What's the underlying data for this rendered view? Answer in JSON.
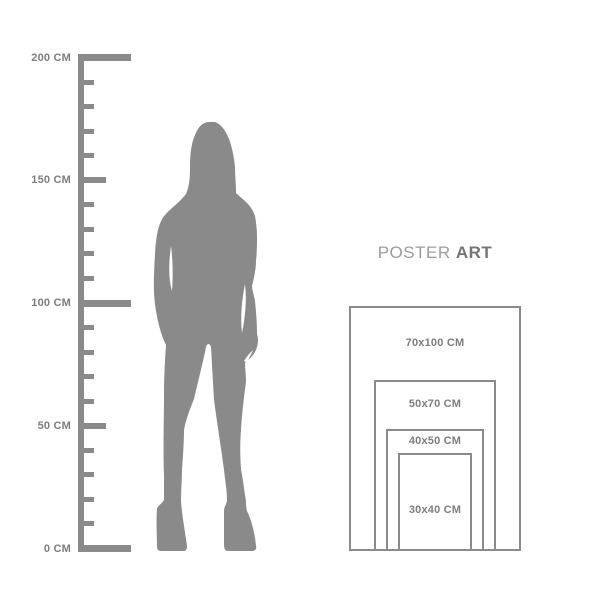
{
  "title": {
    "normal": "POSTER",
    "bold": "ART"
  },
  "ruler": {
    "unit": "CM",
    "max_cm": 200,
    "minor_step_cm": 10,
    "labels": [
      {
        "cm": 200,
        "text": "200 CM"
      },
      {
        "cm": 150,
        "text": "150 CM"
      },
      {
        "cm": 100,
        "text": "100 CM"
      },
      {
        "cm": 50,
        "text": "50 CM"
      },
      {
        "cm": 0,
        "text": "0 CM"
      }
    ]
  },
  "figure": {
    "name": "woman-silhouette",
    "color": "#8a8a8a"
  },
  "posters": {
    "sizes": [
      {
        "id": "70x100",
        "label": "70x100 CM",
        "width_cm": 70,
        "height_cm": 100
      },
      {
        "id": "50x70",
        "label": "50x70 CM",
        "width_cm": 50,
        "height_cm": 70
      },
      {
        "id": "40x50",
        "label": "40x50 CM",
        "width_cm": 40,
        "height_cm": 50
      },
      {
        "id": "30x40",
        "label": "30x40 CM",
        "width_cm": 30,
        "height_cm": 40
      }
    ]
  },
  "colors": {
    "background": "#ffffff",
    "shape_gray": "#8a8a8a",
    "line_gray": "#8a8a8a",
    "text_gray": "#7d7d7d",
    "title_normal": "#9c9c9c",
    "title_bold": "#757575"
  }
}
